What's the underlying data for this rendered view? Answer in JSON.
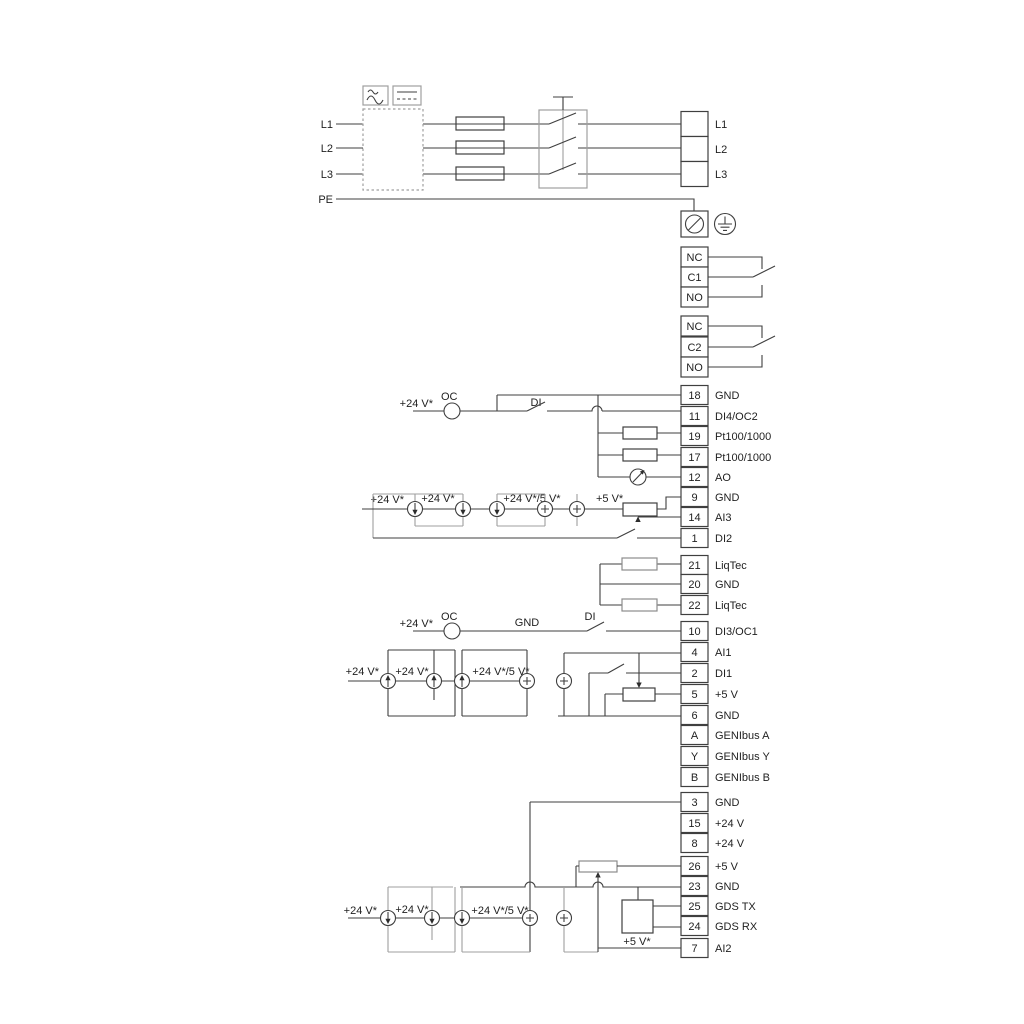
{
  "power": {
    "inputs": [
      "L1",
      "L2",
      "L3",
      "PE"
    ],
    "outputs": [
      "L1",
      "L2",
      "L3"
    ]
  },
  "terminals": {
    "top": [
      {
        "no": "",
        "label": "L1"
      },
      {
        "no": "",
        "label": "L2"
      },
      {
        "no": "",
        "label": "L3"
      }
    ],
    "r1": [
      {
        "no": "NC",
        "label": ""
      },
      {
        "no": "C1",
        "label": ""
      },
      {
        "no": "NO",
        "label": ""
      }
    ],
    "r2": [
      {
        "no": "NC",
        "label": ""
      },
      {
        "no": "C2",
        "label": ""
      },
      {
        "no": "NO",
        "label": ""
      }
    ],
    "g1": [
      {
        "no": "18",
        "label": "GND"
      },
      {
        "no": "11",
        "label": "DI4/OC2"
      },
      {
        "no": "19",
        "label": "Pt100/1000"
      },
      {
        "no": "17",
        "label": "Pt100/1000"
      },
      {
        "no": "12",
        "label": "AO"
      },
      {
        "no": "9",
        "label": "GND"
      },
      {
        "no": "14",
        "label": "AI3"
      },
      {
        "no": "1",
        "label": "DI2"
      }
    ],
    "g2": [
      {
        "no": "21",
        "label": "LiqTec"
      },
      {
        "no": "20",
        "label": "GND"
      },
      {
        "no": "22",
        "label": "LiqTec"
      }
    ],
    "g3": [
      {
        "no": "10",
        "label": "DI3/OC1"
      },
      {
        "no": "4",
        "label": "AI1"
      },
      {
        "no": "2",
        "label": "DI1"
      },
      {
        "no": "5",
        "label": "+5 V"
      },
      {
        "no": "6",
        "label": "GND"
      },
      {
        "no": "A",
        "label": "GENIbus A"
      },
      {
        "no": "Y",
        "label": "GENIbus Y"
      },
      {
        "no": "B",
        "label": "GENIbus B"
      }
    ],
    "g4": [
      {
        "no": "3",
        "label": "GND"
      },
      {
        "no": "15",
        "label": "+24 V"
      },
      {
        "no": "8",
        "label": "+24 V"
      },
      {
        "no": "26",
        "label": "+5 V"
      },
      {
        "no": "23",
        "label": "GND"
      },
      {
        "no": "25",
        "label": "GDS TX"
      },
      {
        "no": "24",
        "label": "GDS RX"
      },
      {
        "no": "7",
        "label": "AI2"
      }
    ]
  },
  "annotations": {
    "di4": {
      "v24": "+24 V*",
      "oc": "OC",
      "di": "DI"
    },
    "ai3": {
      "v24a": "+24 V*",
      "v24b": "+24 V*",
      "v24_5": "+24 V*/5 V*",
      "v5": "+5 V*"
    },
    "di3": {
      "v24": "+24 V*",
      "oc": "OC",
      "gnd": "GND",
      "di": "DI"
    },
    "ai1": {
      "v24a": "+24 V*",
      "v24b": "+24 V*",
      "v24_5": "+24 V*/5 V*"
    },
    "ai2": {
      "v24a": "+24 V*",
      "v24b": "+24 V*",
      "v24_5": "+24 V*/5 V*",
      "v5": "+5 V*"
    }
  },
  "colors": {
    "wire": "#3f3f3f",
    "light_wire": "#9f9f9f",
    "text": "#1f1f1f",
    "background": "#ffffff"
  }
}
